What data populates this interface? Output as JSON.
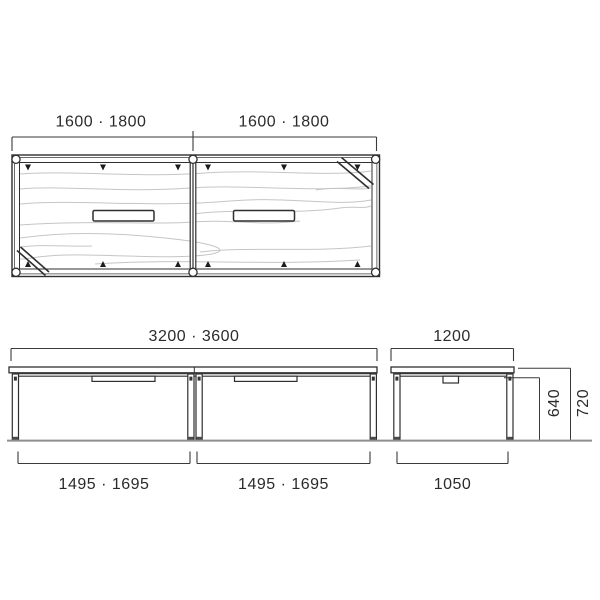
{
  "drawing": {
    "type": "furniture-dimension-diagram",
    "plan_view": {
      "section_labels": [
        "1600 · 1800",
        "1600 · 1800"
      ]
    },
    "front_view": {
      "overall_width_label": "3200 · 3600",
      "leg_span_labels": [
        "1495 · 1695",
        "1495 · 1695"
      ]
    },
    "side_view": {
      "depth_label": "1200",
      "leg_span_label": "1050",
      "underframe_height_label": "640",
      "overall_height_label": "720"
    },
    "dimensions_mm": {
      "section_lengths": [
        1600,
        1800
      ],
      "overall_lengths": [
        3200,
        3600
      ],
      "leg_spans": [
        1495,
        1695
      ],
      "depth": 1200,
      "side_leg_span": 1050,
      "height_to_underframe": 640,
      "height_to_top": 720
    },
    "colors": {
      "line": "#2f2f2f",
      "dimension_line": "#3a3a3a",
      "wood_grain": "#c5c5c5",
      "ground": "#8f8f8f",
      "background": "#ffffff"
    }
  }
}
